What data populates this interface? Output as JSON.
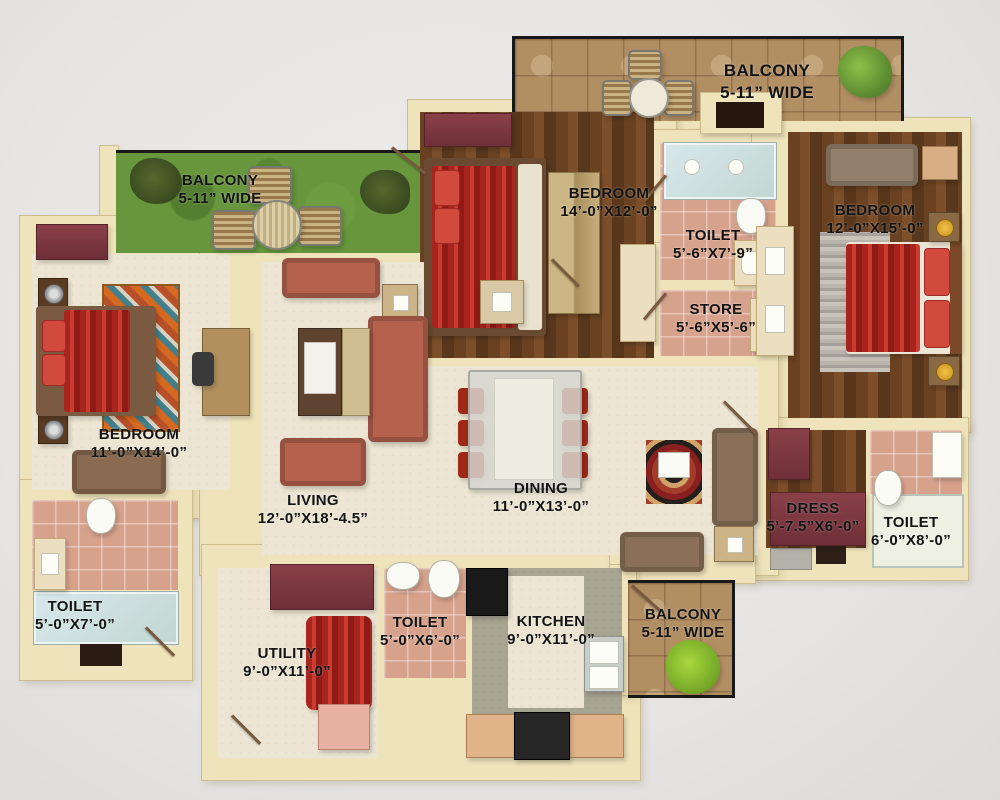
{
  "plan_title": "apartment-floor-plan",
  "rooms": [
    {
      "id": "balcony-top-right",
      "label": "BALCONY",
      "dims": "5-11” WIDE"
    },
    {
      "id": "balcony-top-left",
      "label": "BALCONY",
      "dims": "5-11” WIDE"
    },
    {
      "id": "bedroom-top",
      "label": "BEDROOM",
      "dims": "14’-0”X12’-0”"
    },
    {
      "id": "toilet-top",
      "label": "TOILET",
      "dims": "5’-6”X7’-9”"
    },
    {
      "id": "store",
      "label": "STORE",
      "dims": "5’-6”X5’-6”"
    },
    {
      "id": "bedroom-right",
      "label": "BEDROOM",
      "dims": "12’-0”X15’-0”"
    },
    {
      "id": "bedroom-left",
      "label": "BEDROOM",
      "dims": "11’-0”X14’-0”"
    },
    {
      "id": "living",
      "label": "LIVING",
      "dims": "12’-0”X18’-4.5”"
    },
    {
      "id": "dining",
      "label": "DINING",
      "dims": "11’-0”X13’-0”"
    },
    {
      "id": "dress",
      "label": "DRESS",
      "dims": "5’-7.5”X6’-0”"
    },
    {
      "id": "toilet-right",
      "label": "TOILET",
      "dims": "6’-0”X8’-0”"
    },
    {
      "id": "toilet-left",
      "label": "TOILET",
      "dims": "5’-0”X7’-0”"
    },
    {
      "id": "utility",
      "label": "UTILITY",
      "dims": "9’-0”X11’-0”"
    },
    {
      "id": "toilet-bottom",
      "label": "TOILET",
      "dims": "5’-0”X6’-0”"
    },
    {
      "id": "kitchen",
      "label": "KITCHEN",
      "dims": "9’-0”X11’-0”"
    },
    {
      "id": "balcony-bottom",
      "label": "BALCONY",
      "dims": "5-11” WIDE"
    }
  ],
  "colors": {
    "wall": "#efe3bb",
    "wood_floor": "#6a4222",
    "pink_tile": "#d7a28c",
    "grass": "#67963d",
    "tan_tile": "#b28e63",
    "cream_floor": "#ece5d3",
    "red_fabric": "#c02a22",
    "maroon_cabinet": "#7d3b44",
    "label_text": "#131313",
    "background": "#e8e6e4"
  }
}
